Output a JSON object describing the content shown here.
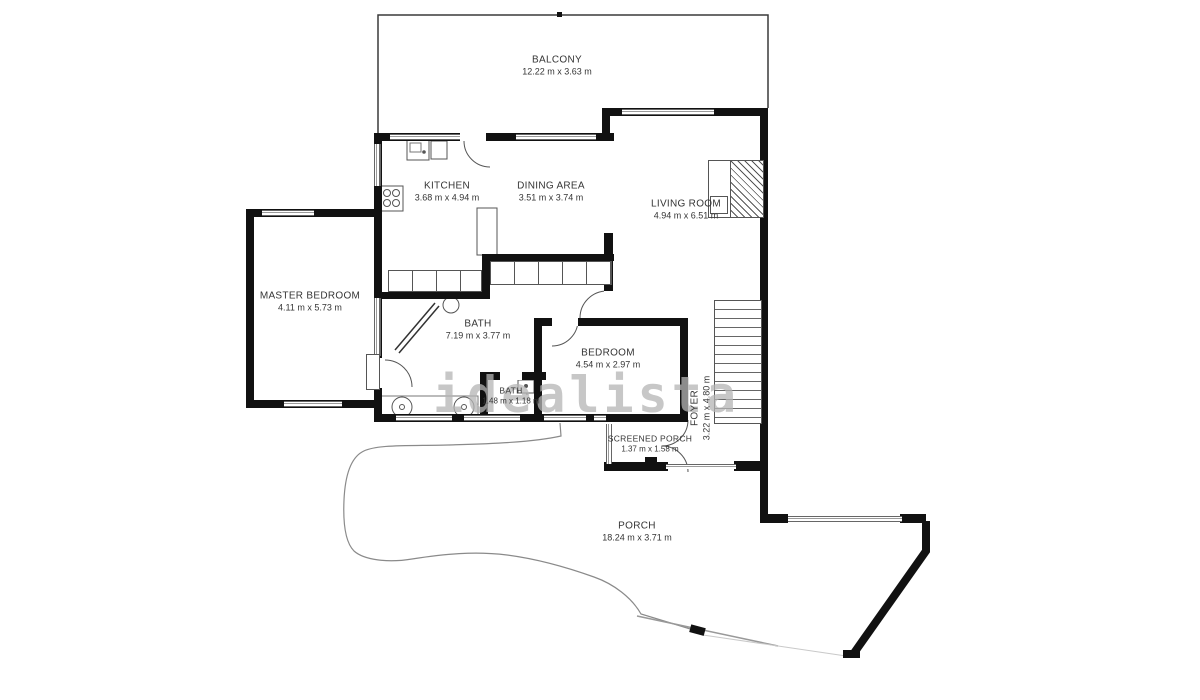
{
  "watermark": "idealista",
  "rooms": [
    {
      "id": "balcony",
      "name": "BALCONY",
      "dims": "12.22 m x 3.63 m"
    },
    {
      "id": "kitchen",
      "name": "KITCHEN",
      "dims": "3.68 m x 4.94 m"
    },
    {
      "id": "dining-area",
      "name": "DINING AREA",
      "dims": "3.51 m x 3.74 m"
    },
    {
      "id": "living-room",
      "name": "LIVING ROOM",
      "dims": "4.94 m x 6.51 m"
    },
    {
      "id": "master-bedroom",
      "name": "MASTER BEDROOM",
      "dims": "4.11 m x 5.73 m"
    },
    {
      "id": "bath",
      "name": "BATH",
      "dims": "7.19 m x 3.77 m"
    },
    {
      "id": "bath-small",
      "name": "BATH",
      "dims": "1.48 m x 1.18 m"
    },
    {
      "id": "bedroom",
      "name": "BEDROOM",
      "dims": "4.54 m x 2.97 m"
    },
    {
      "id": "foyer",
      "name": "FOYER",
      "dims": "3.22 m x 4.80 m"
    },
    {
      "id": "screened-porch",
      "name": "SCREENED PORCH",
      "dims": "1.37 m x 1.58 m"
    },
    {
      "id": "porch",
      "name": "PORCH",
      "dims": "18.24 m x 3.71 m"
    }
  ],
  "colors": {
    "wall": "#111111",
    "window_line": "#666666",
    "watermark": "#b5b5b5",
    "label_text": "#353535"
  }
}
